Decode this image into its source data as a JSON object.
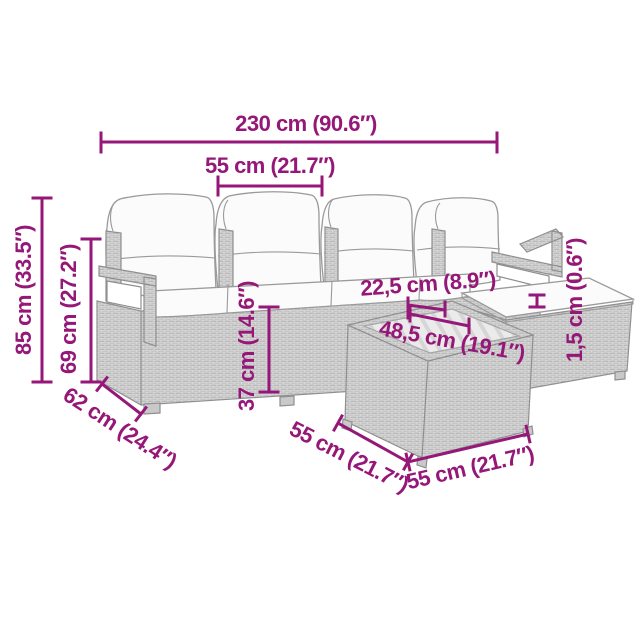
{
  "diagram": {
    "kind": "furniture-dimension-diagram",
    "dims": {
      "overall_width": "230 cm (90.6″)",
      "seat_width": "55 cm (21.7″)",
      "height_total": "85 cm (33.5″)",
      "height_backrest": "69 cm (27.2″)",
      "height_seat": "37 cm (14.6″)",
      "clearance": "22,5 cm (8.9″)",
      "glass_width": "48,5 cm (19.1″)",
      "pad_thickness": "1,5 cm (0.6″)",
      "sofa_depth": "62 cm (24.4″)",
      "table_side_left": "55 cm (21.7″)",
      "table_side_right": "55 cm (21.7″)"
    }
  },
  "colors": {
    "dimension_accent": "#951778",
    "furniture_outline": "#8F8F8F",
    "rattan_fill": "#D9D9D9",
    "background": "#FFFFFF"
  }
}
